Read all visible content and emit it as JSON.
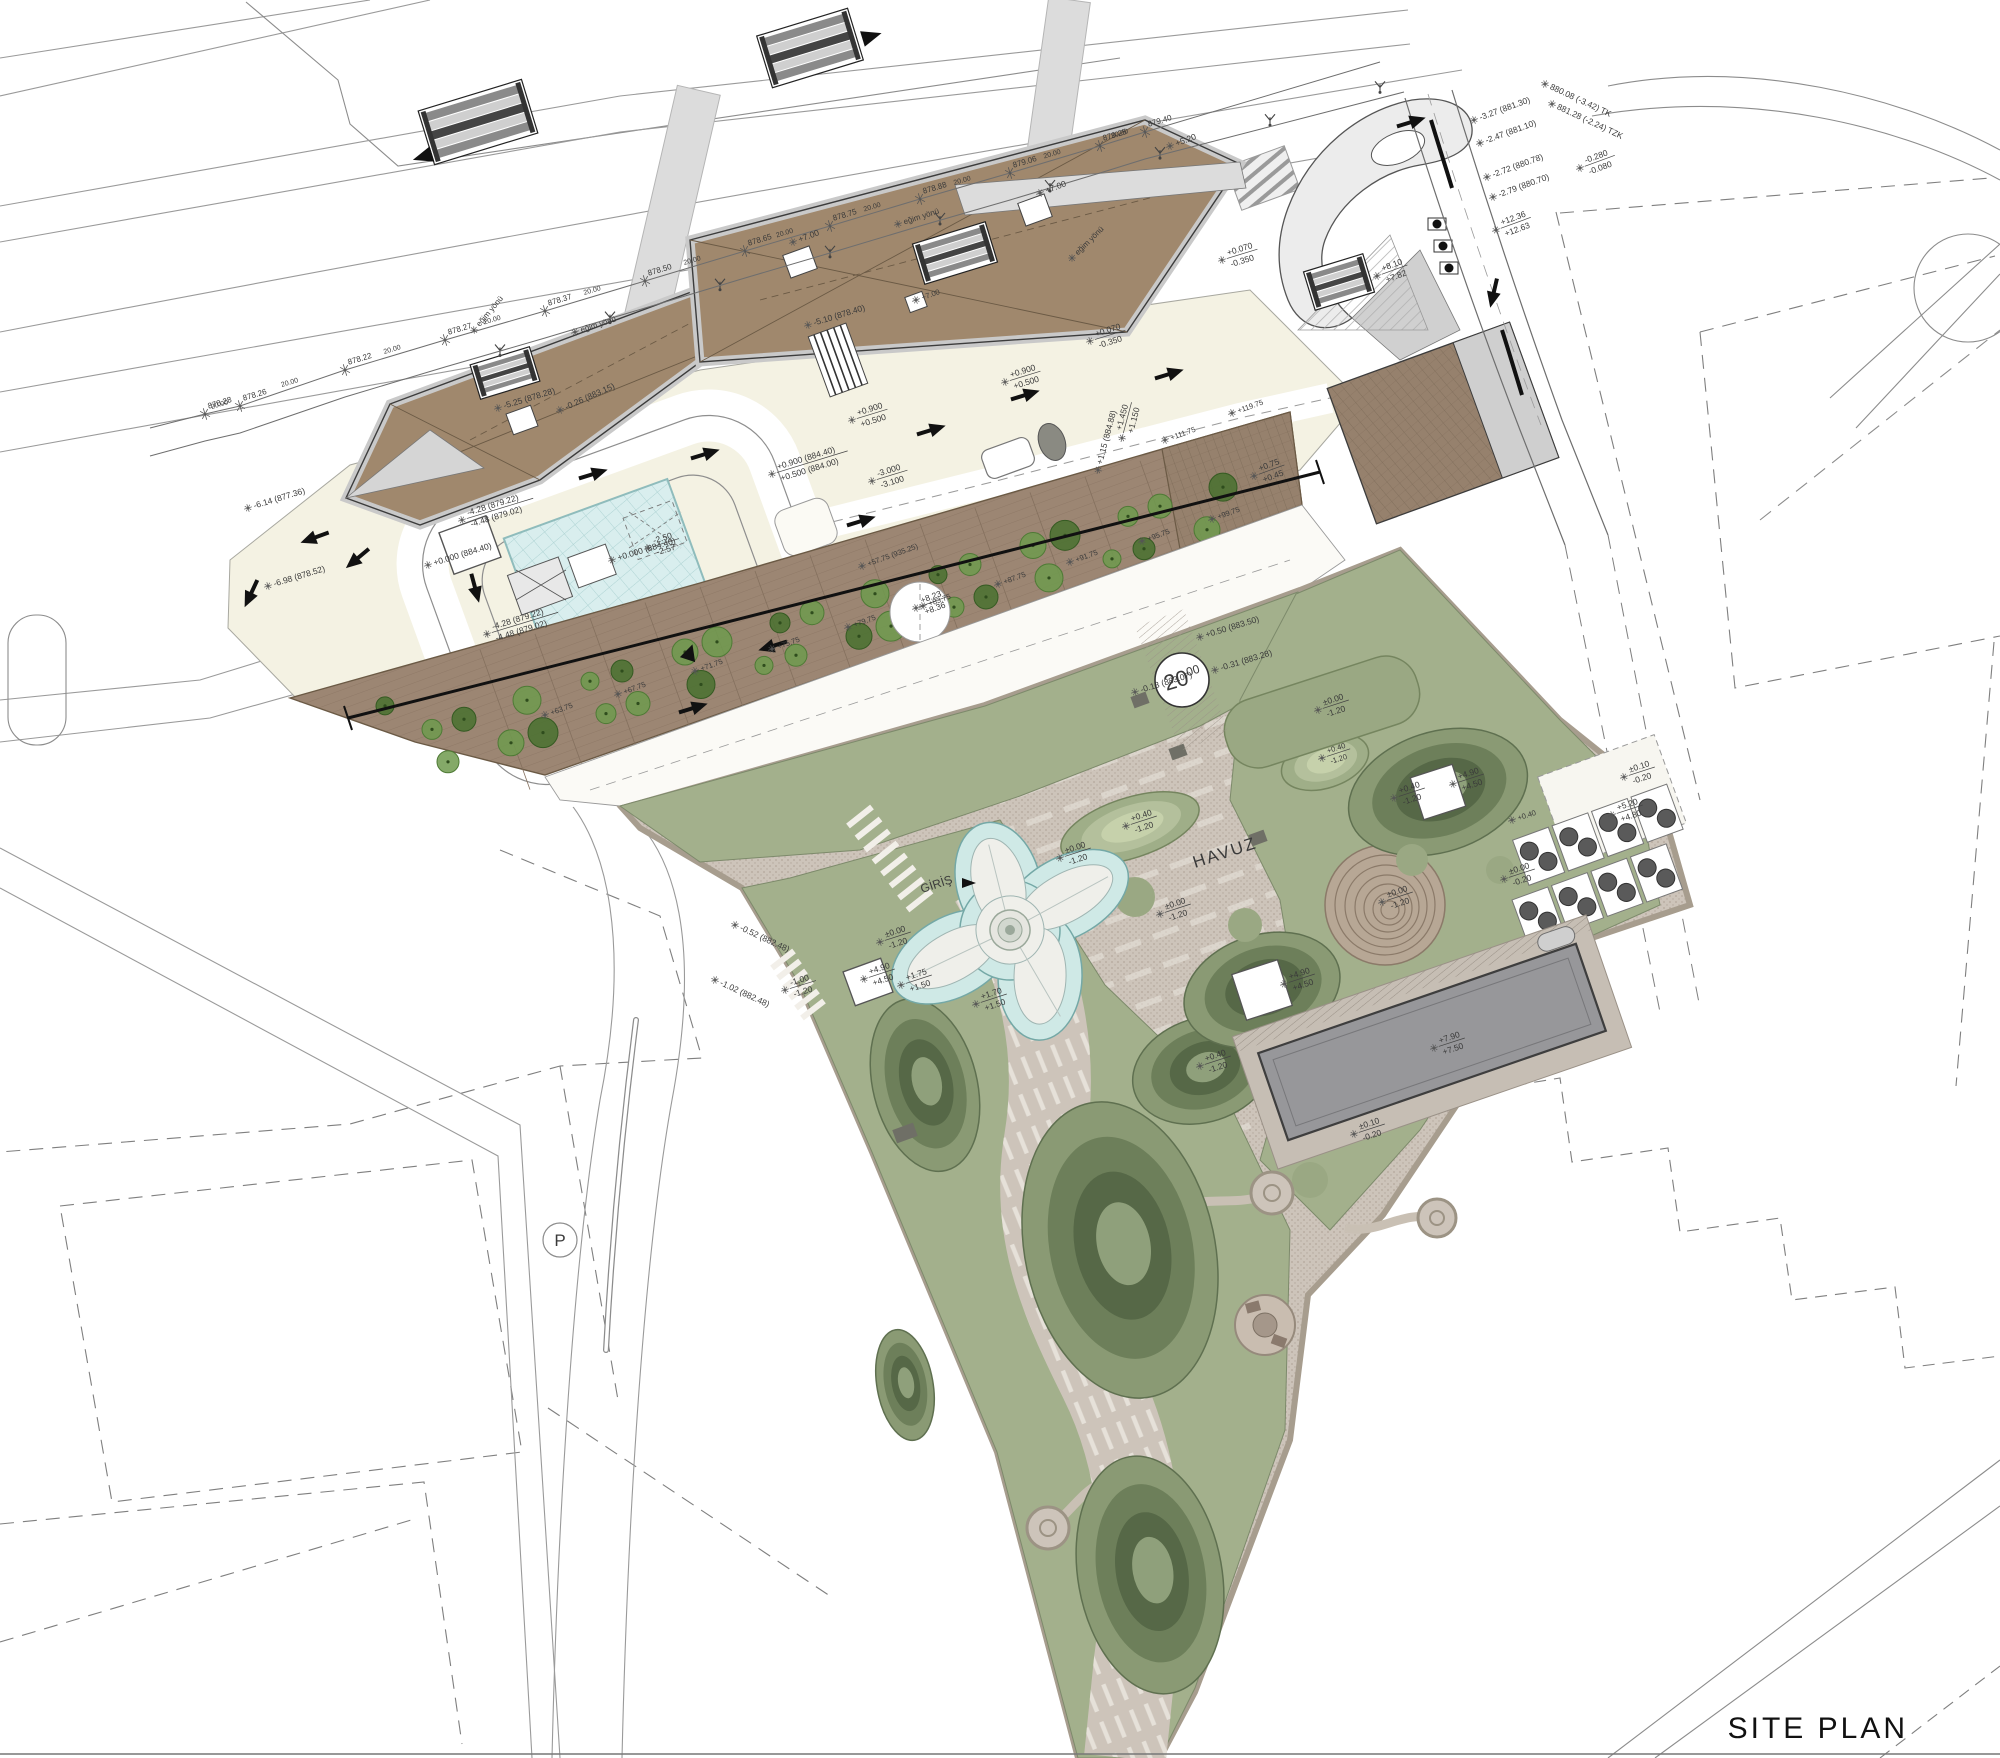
{
  "title": {
    "text": "SITE PLAN"
  },
  "labels": {
    "pool": "HAVUZ",
    "entrance": "GİRİŞ",
    "slope_direction": "eğim yönü",
    "parking_symbol": "P",
    "road_width_main": "20",
    "road_width_decimals": "00",
    "road_spacing": "20.00"
  },
  "colors": {
    "roof_brown": "#a0886d",
    "roof_edge_gray": "#c9c9c9",
    "terrace_brown": "#9c8673",
    "plaza_cream": "#f4f2e3",
    "park_paving": "#cdc4ba",
    "park_border": "#a79d8e",
    "sage_green": "#a3b08c",
    "mound_mid": "#6d7f5d",
    "mound_dark": "#4e5f44",
    "water_blue": "#cfe9e6",
    "grid_pool_blue": "#d9eeee",
    "lap_pool_gray": "#97979a",
    "tree_green": "#6f9a4e",
    "tree_dark_green": "#49712f",
    "line_gray": "#9a9a9a",
    "ink": "#2f2f2f"
  },
  "road_markers": [
    {
      "label": "878.28",
      "x": 205,
      "y": 414
    },
    {
      "label": "878.26",
      "x": 240,
      "y": 406
    },
    {
      "label": "878.22",
      "x": 345,
      "y": 370
    },
    {
      "label": "878.27",
      "x": 445,
      "y": 340
    },
    {
      "label": "878.37",
      "x": 545,
      "y": 311
    },
    {
      "label": "878.50",
      "x": 645,
      "y": 281
    },
    {
      "label": "878.65",
      "x": 745,
      "y": 251
    },
    {
      "label": "878.75",
      "x": 830,
      "y": 226
    },
    {
      "label": "878.88",
      "x": 920,
      "y": 199
    },
    {
      "label": "879.06",
      "x": 1010,
      "y": 173
    },
    {
      "label": "879.25",
      "x": 1100,
      "y": 146
    },
    {
      "label": "879.40",
      "x": 1145,
      "y": 132
    }
  ],
  "annotations": [
    {
      "t": "-6.14 (877.36)",
      "x": 248,
      "y": 508,
      "r": -17
    },
    {
      "t": "-6.98 (878.52)",
      "x": 268,
      "y": 586,
      "r": -17
    },
    {
      "t": "-5.25 (878.28)",
      "x": 498,
      "y": 408,
      "r": -17
    },
    {
      "t": "-4.28 (879.22)",
      "b": "-4.48 (879.02)",
      "x": 462,
      "y": 520,
      "r": -17
    },
    {
      "t": "-4.28 (879.22)",
      "b": "-4.48 (879.02)",
      "x": 487,
      "y": 634,
      "r": -17
    },
    {
      "t": "+0.000 (884.40)",
      "x": 428,
      "y": 565,
      "r": -17
    },
    {
      "t": "+0.000 (884.40)",
      "x": 612,
      "y": 560,
      "r": -17
    },
    {
      "t": "-2.50",
      "b": "-2.57",
      "x": 648,
      "y": 548,
      "r": -17
    },
    {
      "t": "-5.10 (878.40)",
      "x": 808,
      "y": 325,
      "r": -17
    },
    {
      "t": "+0.900",
      "b": "+0.500",
      "x": 852,
      "y": 420,
      "r": -17
    },
    {
      "t": "+0.900 (884.40)",
      "b": "+0.500 (884.00)",
      "x": 772,
      "y": 474,
      "r": -17
    },
    {
      "t": "-3.000",
      "b": "-3.100",
      "x": 872,
      "y": 481,
      "r": -17
    },
    {
      "t": "+0.070",
      "b": "-0.350",
      "x": 1090,
      "y": 341,
      "r": -17
    },
    {
      "t": "+0.070",
      "b": "-0.350",
      "x": 1222,
      "y": 260,
      "r": -17
    },
    {
      "t": "+0.900",
      "b": "+0.500",
      "x": 1005,
      "y": 382,
      "r": -17
    },
    {
      "t": "+1.15 (884.88)",
      "x": 1098,
      "y": 470,
      "r": -75
    },
    {
      "t": "+1.450",
      "b": "+1.150",
      "x": 1122,
      "y": 438,
      "r": -75
    },
    {
      "t": "+0.75",
      "b": "+0.45",
      "x": 1254,
      "y": 476,
      "r": -20
    },
    {
      "t": "+12.36",
      "b": "+12.63",
      "x": 1496,
      "y": 230,
      "r": -20
    },
    {
      "t": "+8.10",
      "b": "+7.82",
      "x": 1377,
      "y": 276,
      "r": -20
    },
    {
      "t": "-0.280",
      "b": "-0.080",
      "x": 1580,
      "y": 168,
      "r": -20
    },
    {
      "t": "880.08 (-3.42) TK",
      "x": 1545,
      "y": 84,
      "r": 25
    },
    {
      "t": "881.28 (-2.24) TZK",
      "x": 1552,
      "y": 104,
      "r": 25
    },
    {
      "t": "-3.27 (881.30)",
      "x": 1474,
      "y": 120,
      "r": -20
    },
    {
      "t": "-2.47 (881.10)",
      "x": 1480,
      "y": 143,
      "r": -20
    },
    {
      "t": "-2.72 (880.78)",
      "x": 1487,
      "y": 177,
      "r": -20
    },
    {
      "t": "-2.79 (880.70)",
      "x": 1493,
      "y": 197,
      "r": -20
    },
    {
      "t": "+5.20",
      "x": 1170,
      "y": 146,
      "r": -20
    },
    {
      "t": "+7.00",
      "x": 1040,
      "y": 193,
      "r": -20
    },
    {
      "t": "+7.00",
      "x": 793,
      "y": 242,
      "r": -20
    },
    {
      "t": "+7.00",
      "x": 916,
      "y": 300,
      "r": -20,
      "s": 7.5
    },
    {
      "t": "-0.26 (883.15)",
      "x": 560,
      "y": 410,
      "r": -24
    },
    {
      "t": "+8.23",
      "b": "+8.36",
      "x": 916,
      "y": 608,
      "r": -20
    },
    {
      "t": "+57.75 (935.25)",
      "x": 862,
      "y": 566,
      "r": -20,
      "s": 7.5
    },
    {
      "t": "+63.75",
      "x": 545,
      "y": 715,
      "r": -20,
      "s": 7.5
    },
    {
      "t": "+67.75",
      "x": 618,
      "y": 694,
      "r": -20,
      "s": 7.5
    },
    {
      "t": "+71.75",
      "x": 695,
      "y": 671,
      "r": -20,
      "s": 7.5
    },
    {
      "t": "+75.75",
      "x": 772,
      "y": 649,
      "r": -20,
      "s": 7.5
    },
    {
      "t": "+79.75",
      "x": 848,
      "y": 627,
      "r": -20,
      "s": 7.5
    },
    {
      "t": "+83.75",
      "x": 923,
      "y": 606,
      "r": -20,
      "s": 7.5
    },
    {
      "t": "+87.75",
      "x": 998,
      "y": 584,
      "r": -20,
      "s": 7.5
    },
    {
      "t": "+91.75",
      "x": 1070,
      "y": 562,
      "r": -20,
      "s": 7.5
    },
    {
      "t": "+95.75",
      "x": 1142,
      "y": 541,
      "r": -20,
      "s": 7.5
    },
    {
      "t": "+99.75",
      "x": 1212,
      "y": 519,
      "r": -20,
      "s": 7.5
    },
    {
      "t": "+111.75",
      "x": 1165,
      "y": 440,
      "r": -20,
      "s": 7.5
    },
    {
      "t": "+119.75",
      "x": 1232,
      "y": 413,
      "r": -20,
      "s": 7.5
    },
    {
      "t": "-0.31 (883.28)",
      "x": 1215,
      "y": 670,
      "r": -17
    },
    {
      "t": "-0.13 (883.07)",
      "x": 1135,
      "y": 692,
      "r": -17
    },
    {
      "t": "+0.50 (883.50)",
      "x": 1200,
      "y": 637,
      "r": -17
    },
    {
      "t": "-0.52 (882.48)",
      "x": 735,
      "y": 925,
      "r": 25
    },
    {
      "t": "-1.02 (882.48)",
      "x": 715,
      "y": 980,
      "r": 25
    },
    {
      "t": "-1.00",
      "b": "-1.20",
      "x": 785,
      "y": 990,
      "r": -17
    },
    {
      "t": "+0.40",
      "b": "-1.20",
      "x": 1126,
      "y": 826,
      "r": -18
    },
    {
      "t": "+0.40",
      "b": "-1.20",
      "x": 1200,
      "y": 1066,
      "r": -18
    },
    {
      "t": "+0.40",
      "b": "-1.20",
      "x": 1394,
      "y": 798,
      "r": -18
    },
    {
      "t": "+0.40",
      "b": "-1.20",
      "x": 1322,
      "y": 758,
      "r": -18,
      "s": 7.5
    },
    {
      "t": "±0.00",
      "b": "-1.20",
      "x": 1318,
      "y": 710,
      "r": -18
    },
    {
      "t": "±0.00",
      "b": "-1.20",
      "x": 1160,
      "y": 914,
      "r": -18
    },
    {
      "t": "±0.00",
      "b": "-1.20",
      "x": 1060,
      "y": 858,
      "r": -18
    },
    {
      "t": "±0.00",
      "b": "-1.20",
      "x": 880,
      "y": 942,
      "r": -18
    },
    {
      "t": "±0.00",
      "b": "-1.20",
      "x": 1382,
      "y": 902,
      "r": -18
    },
    {
      "t": "+4.90",
      "b": "+4.50",
      "x": 1284,
      "y": 984,
      "r": -18
    },
    {
      "t": "+4.90",
      "b": "+4.50",
      "x": 1453,
      "y": 784,
      "r": -18
    },
    {
      "t": "+4.90",
      "b": "+4.50",
      "x": 864,
      "y": 979,
      "r": -18
    },
    {
      "t": "+5.20",
      "b": "+4.80",
      "x": 1612,
      "y": 815,
      "r": -18
    },
    {
      "t": "±0.10",
      "b": "-0.20",
      "x": 1624,
      "y": 777,
      "r": -18
    },
    {
      "t": "±0.10",
      "b": "-0.20",
      "x": 1354,
      "y": 1134,
      "r": -18
    },
    {
      "t": "+7.90",
      "b": "+7.50",
      "x": 1434,
      "y": 1048,
      "r": -18
    },
    {
      "t": "+1.70",
      "b": "+1.50",
      "x": 976,
      "y": 1004,
      "r": -18
    },
    {
      "t": "+1.75",
      "b": "+1.50",
      "x": 901,
      "y": 985,
      "r": -18
    },
    {
      "t": "+0.40",
      "x": 1512,
      "y": 820,
      "r": -18,
      "s": 7.5
    },
    {
      "t": "±0.00",
      "b": "-0.20",
      "x": 1504,
      "y": 879,
      "r": -18
    },
    {
      "t": "eğim yönü",
      "x": 474,
      "y": 330,
      "r": -50,
      "s": 8
    },
    {
      "t": "eğim yönü",
      "x": 575,
      "y": 332,
      "r": -18,
      "s": 8
    },
    {
      "t": "eğim yönü",
      "x": 898,
      "y": 224,
      "r": -18,
      "s": 8
    },
    {
      "t": "eğim yönü",
      "x": 1072,
      "y": 258,
      "r": -45,
      "s": 8
    }
  ]
}
